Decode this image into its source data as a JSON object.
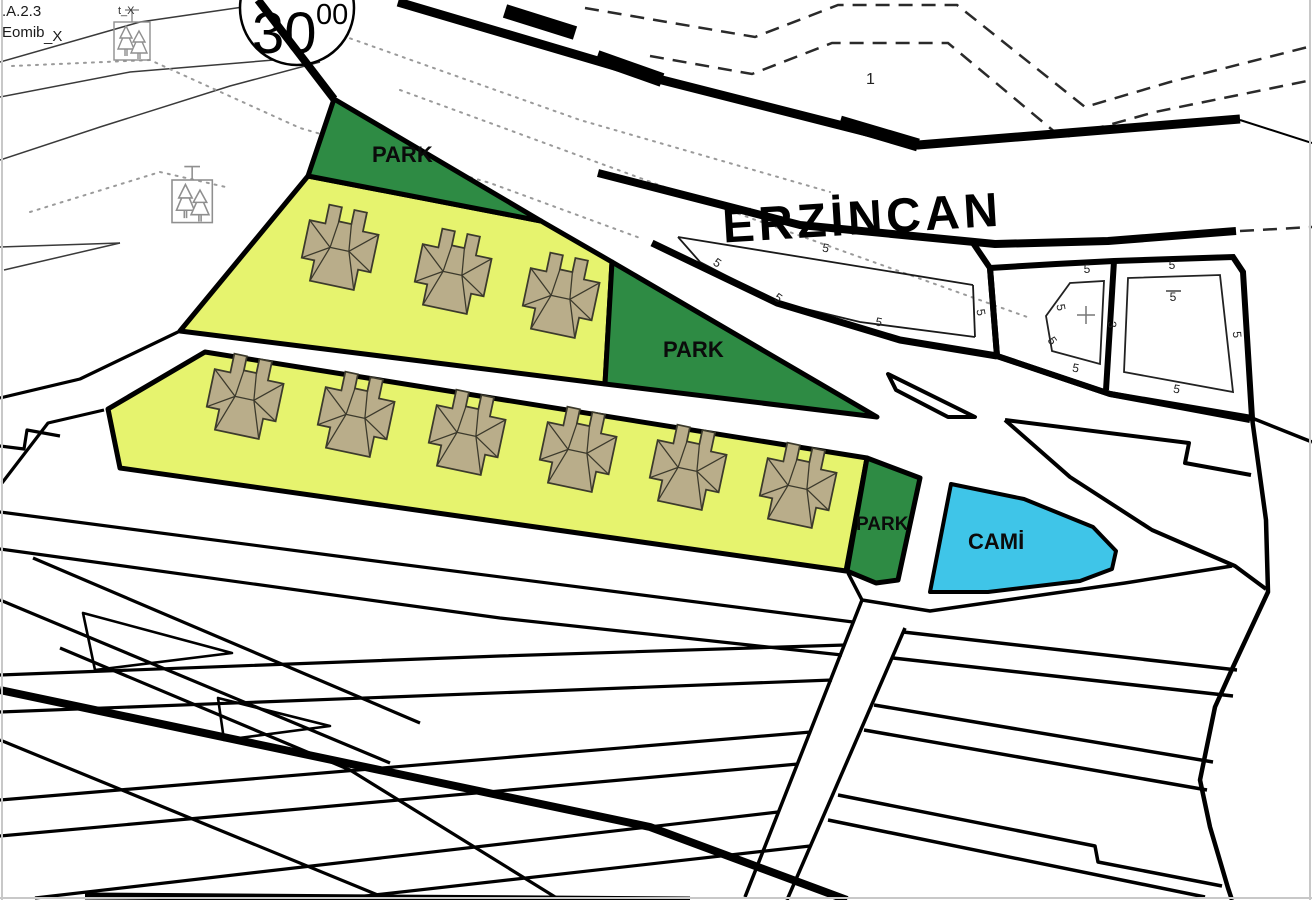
{
  "title_block": {
    "plan_code": ".A.2.3",
    "plan_code_line2": "Eomib",
    "plan_code_line2_suffix": "_X",
    "symbol_label": "t_X"
  },
  "map": {
    "city_label": "ERZİNCAN",
    "road_width_label": {
      "main": "30",
      "sup": "00"
    },
    "region_label": "1",
    "zones": {
      "park_top": "PARK",
      "park_middle": "PARK",
      "park_small": "PARK",
      "mosque": "CAMİ"
    },
    "legend_colors": {
      "park_green": "#2e8b44",
      "residential_yellow": "#e6f36e",
      "mosque_cyan": "#3fc5e8",
      "building_tan": "#b9ad8a",
      "line_black": "#000000",
      "dotted_gray": "#9a9a9a"
    },
    "building_counts": {
      "upper_row_houses": 3,
      "lower_row_houses": 6
    },
    "setbacks": [
      {
        "text": "5",
        "x": 715,
        "y": 266,
        "rot": 35
      },
      {
        "text": "5",
        "x": 776,
        "y": 301,
        "rot": 35
      },
      {
        "text": "5",
        "x": 825,
        "y": 252,
        "rot": 10
      },
      {
        "text": "5",
        "x": 878,
        "y": 326,
        "rot": 12
      },
      {
        "text": "5",
        "x": 977,
        "y": 313,
        "rot": 80
      },
      {
        "text": "5",
        "x": 1087,
        "y": 273,
        "rot": 0
      },
      {
        "text": "5",
        "x": 1057,
        "y": 308,
        "rot": 80
      },
      {
        "text": "5",
        "x": 1049,
        "y": 343,
        "rot": 55
      },
      {
        "text": "5",
        "x": 1075,
        "y": 372,
        "rot": 10
      },
      {
        "text": "3",
        "x": 1108,
        "y": 325,
        "rot": 85
      },
      {
        "text": "5",
        "x": 1172,
        "y": 269,
        "rot": 0
      },
      {
        "text": "5",
        "x": 1173,
        "y": 301,
        "rot": 0,
        "overline": true
      },
      {
        "text": "5",
        "x": 1233,
        "y": 335,
        "rot": 85
      },
      {
        "text": "5",
        "x": 1176,
        "y": 393,
        "rot": 10
      }
    ]
  }
}
